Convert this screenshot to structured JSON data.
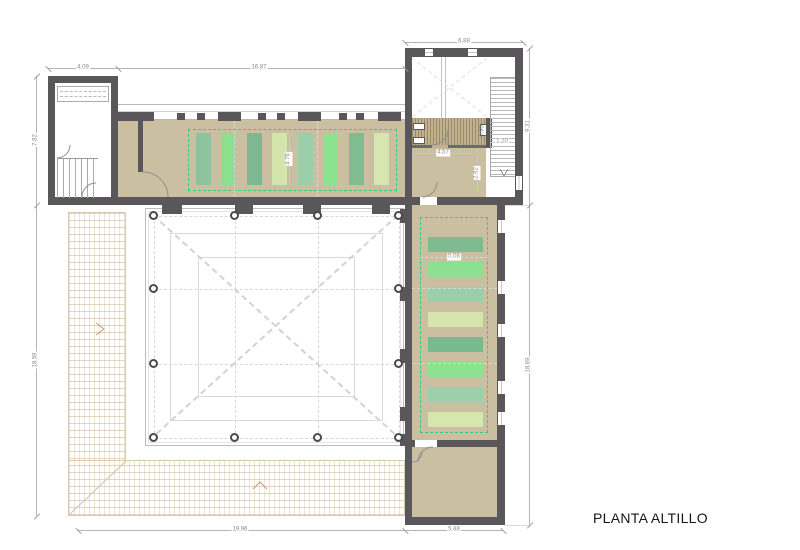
{
  "title": "PLANTA ALTILLO",
  "colors": {
    "wall": "#59575a",
    "floor_tan": "#cbbfa2",
    "bathroom_deck": "#c2b18f",
    "mat_outline_green": "#2fcd7f",
    "paving_line": "#c4a47a",
    "dimension_line": "#b4b4b4",
    "dimension_text": "#8a8a8a"
  },
  "dimensions": {
    "tower_a_width": "4.09",
    "tower_a_height": "7.82",
    "north_wing_width": "16.87",
    "tower_b_width": "6.88",
    "tower_b_height": "9.31",
    "left_total_height": "18.59",
    "right_total_height": "18.69",
    "terrace_width": "19.96",
    "south_room_width": "5.88",
    "north_mat_depth": "4.76",
    "east_mat_width": "5.08",
    "bath_width": "4.57",
    "bath_room_depth": "2.92",
    "stair_width": "1.20",
    "fixture_width": "0.90"
  },
  "mats": {
    "north": [
      "#8fc3a0",
      "#8ce08d",
      "#7fb890",
      "#d3e4ac",
      "#9bcfaa",
      "#8be390",
      "#7fbd90",
      "#d6e6ae"
    ],
    "east": [
      "#7fbb91",
      "#8ce08f",
      "#9bcfab",
      "#d5e5ad",
      "#7ab88d",
      "#8ce28f",
      "#9ad0ab",
      "#d6e7ae"
    ]
  },
  "symbols": {
    "slope_arrow_left": "chevron-right",
    "slope_arrow_bottom": "chevron-up",
    "stair_direction": "chevron-down"
  }
}
